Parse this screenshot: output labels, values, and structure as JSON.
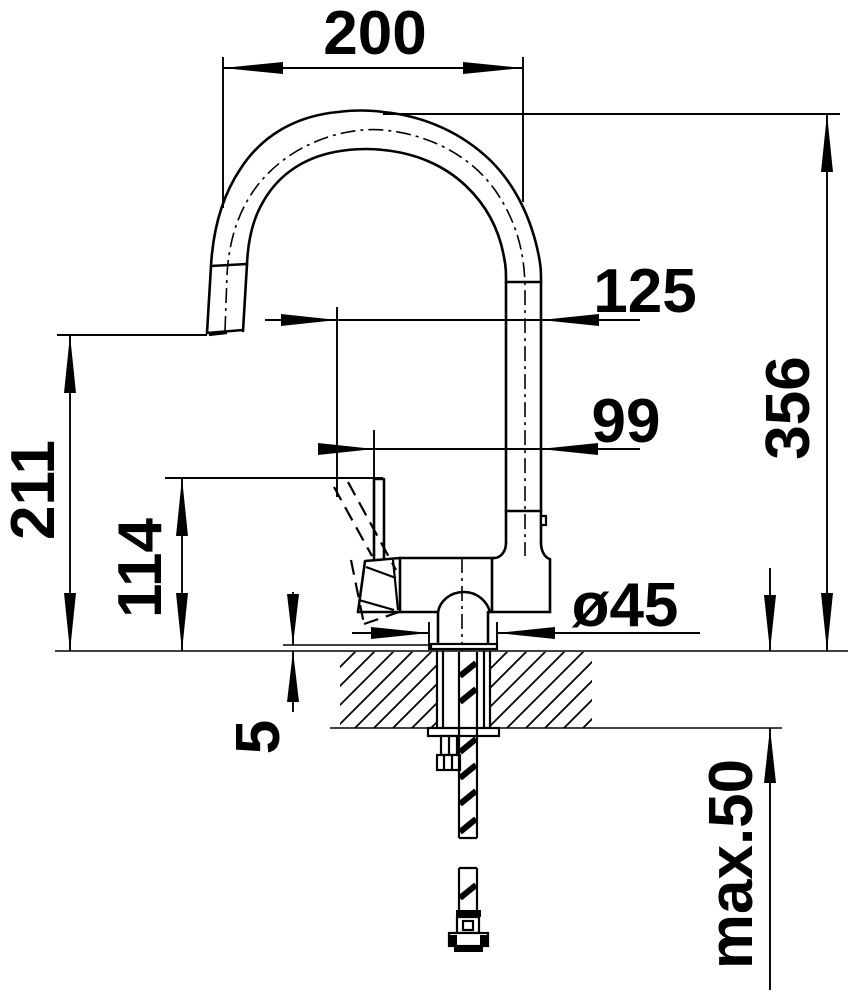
{
  "colors": {
    "ink": "#000000",
    "background": "#ffffff"
  },
  "dims": {
    "w200": "200",
    "h356": "356",
    "off125": "125",
    "off99": "99",
    "h211": "211",
    "h114": "114",
    "dia45": "ø45",
    "gap5": "5",
    "deck": "max.50"
  }
}
